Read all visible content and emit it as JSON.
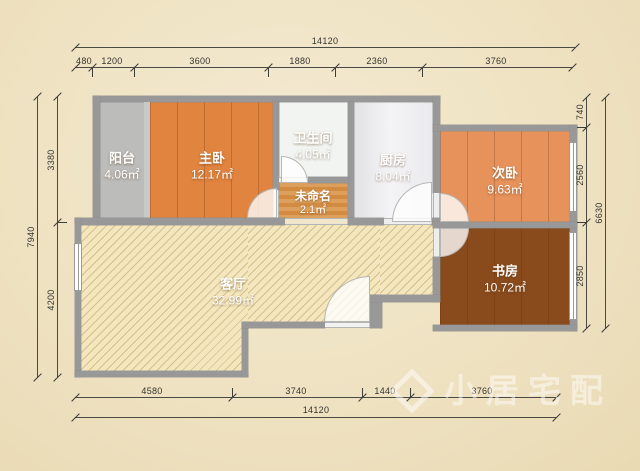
{
  "title": "residential floor plan",
  "watermark": {
    "text": "小居宅配"
  },
  "rooms": [
    {
      "id": "balcony",
      "name": "阳台",
      "area": "4.06㎡"
    },
    {
      "id": "master-bedroom",
      "name": "主卧",
      "area": "12.17㎡"
    },
    {
      "id": "bathroom",
      "name": "卫生间",
      "area": "4.05㎡"
    },
    {
      "id": "kitchen",
      "name": "厨房",
      "area": "8.04㎡"
    },
    {
      "id": "second-bedroom",
      "name": "次卧",
      "area": "9.63㎡"
    },
    {
      "id": "unnamed",
      "name": "未命名",
      "area": "2.1㎡"
    },
    {
      "id": "living-room",
      "name": "客厅",
      "area": "32.99㎡"
    },
    {
      "id": "study",
      "name": "书房",
      "area": "10.72㎡"
    }
  ],
  "dimensions": {
    "top": {
      "total": "14120",
      "segments": [
        "480",
        "1200",
        "3600",
        "1880",
        "2360",
        "3760"
      ]
    },
    "bottom": {
      "total": "14120",
      "segments": [
        "4580",
        "3740",
        "1440",
        "3760"
      ]
    },
    "left": {
      "total": "7940",
      "segments": [
        "3380",
        "4200"
      ]
    },
    "right": {
      "total": "6630",
      "segments": [
        "740",
        "2560",
        "2850"
      ]
    }
  },
  "colors": {
    "paper": "#efe2c2",
    "wall": "#989898",
    "wood_orange": "#e08440",
    "wood_dark": "#8a4b1c",
    "living_cream": "#f4e6bd",
    "tile_gray": "#bcbcba",
    "tile_bath": "#f1f4f0",
    "dimension_ink": "#33332f"
  }
}
